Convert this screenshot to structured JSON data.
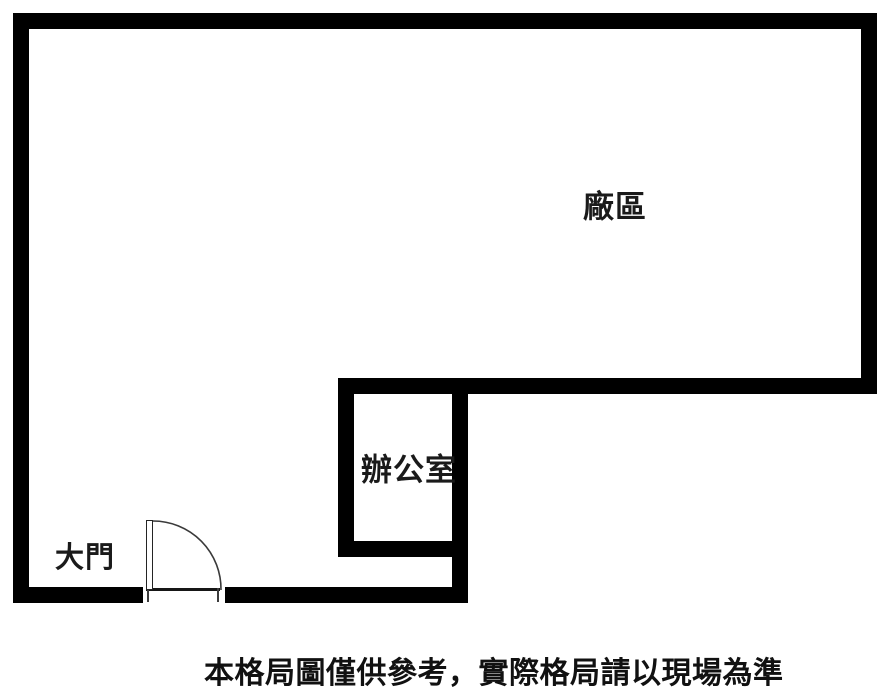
{
  "colors": {
    "wall": "#000000",
    "text": "#1a1a1a",
    "background": "#ffffff",
    "door_line": "#3a3a3a"
  },
  "rooms": {
    "factory": {
      "label": "廠區"
    },
    "office": {
      "label": "辦公室"
    }
  },
  "door": {
    "label": "大門"
  },
  "caption": {
    "text": "本格局圖僅供參考，實際格局請以現場為準"
  }
}
